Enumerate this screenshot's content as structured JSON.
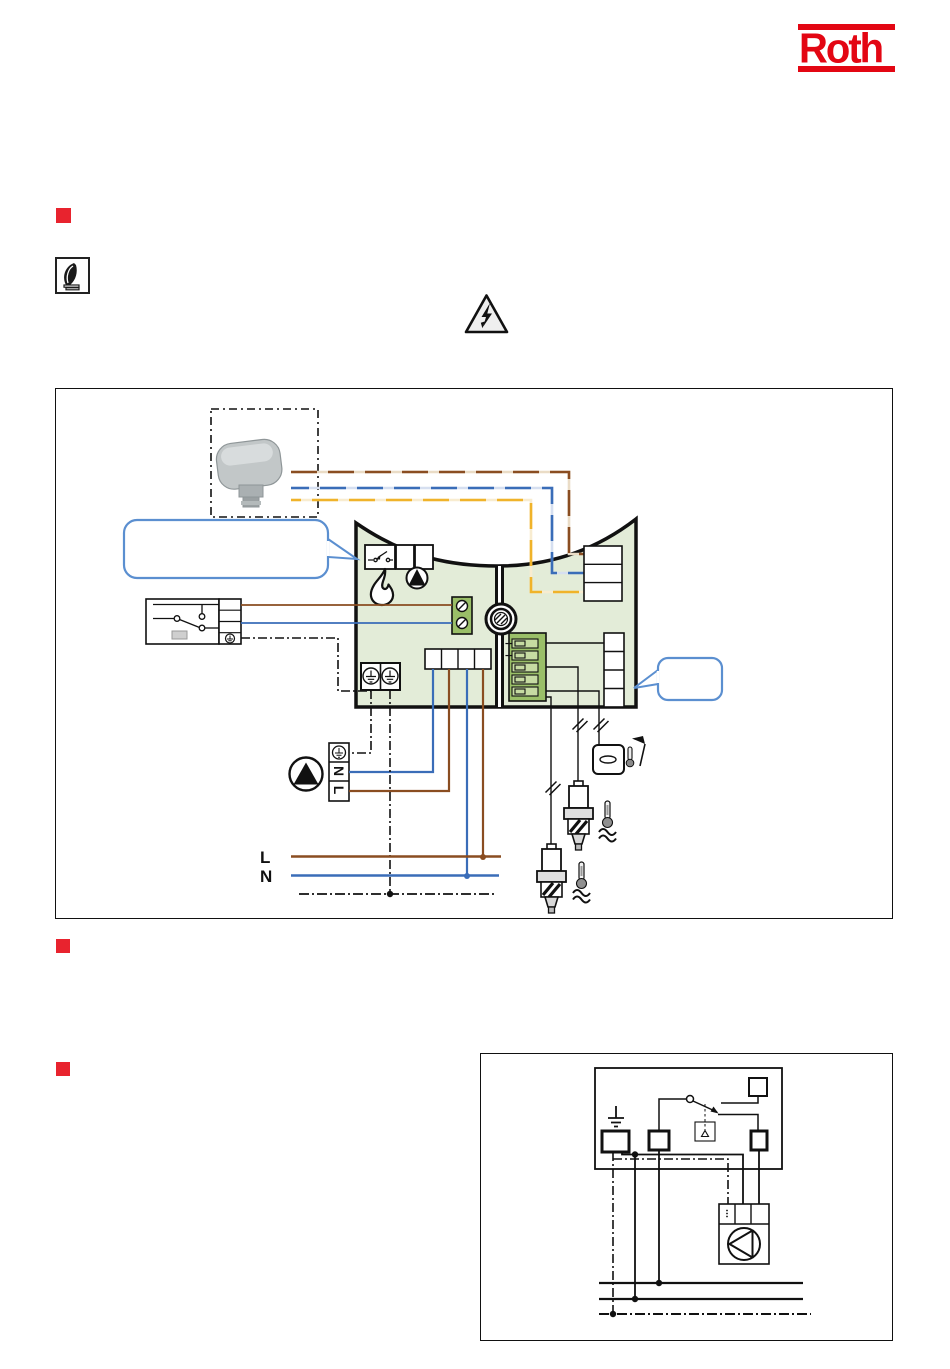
{
  "logo": {
    "text": "Roth",
    "color": "#e30613"
  },
  "theme": {
    "accentRed": "#e30613",
    "bulletRed": "#e8232e",
    "line": "#1a1a1a",
    "brown": "#8a4d21",
    "brownLight": "#eadcc6",
    "blue": "#3a6db8",
    "blueLight": "#d6dff0",
    "yellow": "#f0b32a",
    "yellowLight": "#f8ecd0",
    "sage": "#e3ecd8",
    "green": "#9abf68",
    "calloutBlue": "#5b8fd0"
  },
  "diagram1": {
    "bus_labels": {
      "l": "L",
      "n": "N"
    },
    "pump_labels": {
      "n": "N",
      "l": "L"
    }
  }
}
